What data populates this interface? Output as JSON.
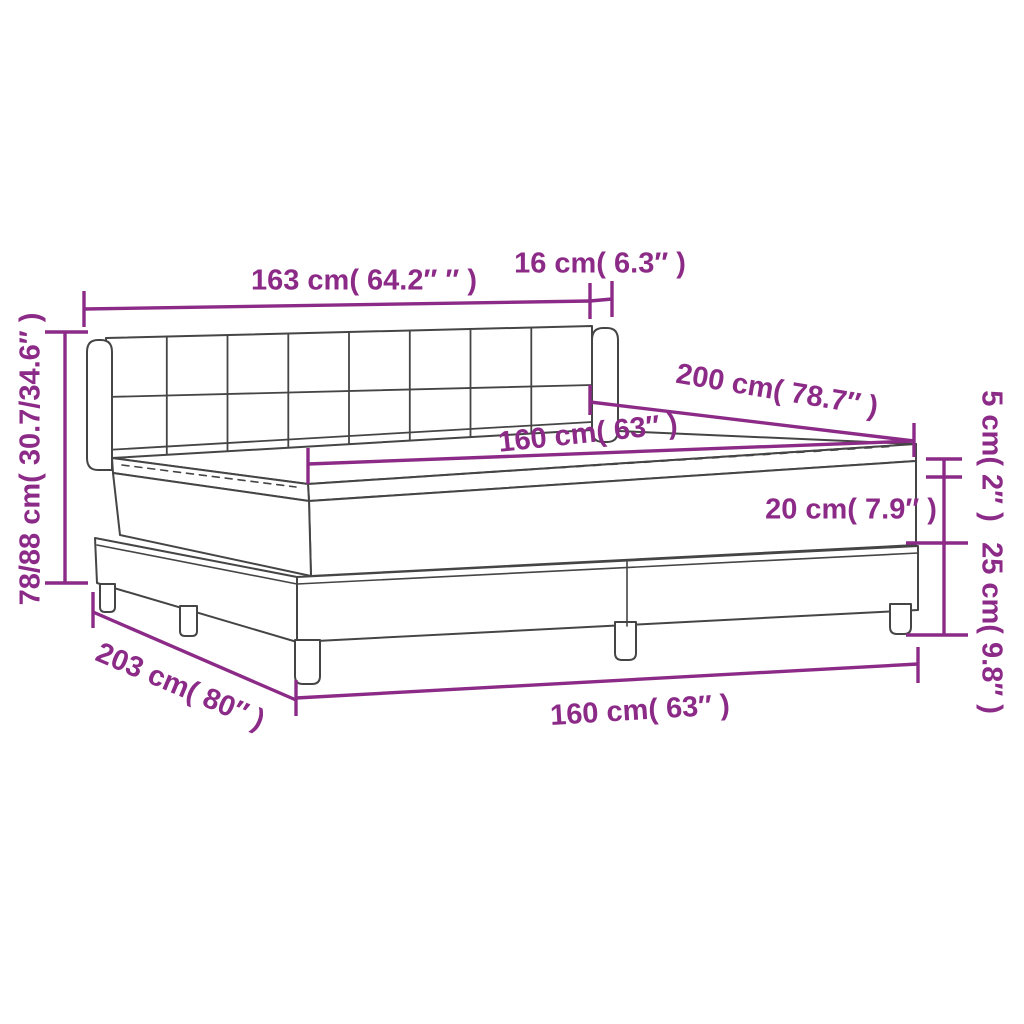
{
  "diagram": {
    "type": "product-dimension-diagram",
    "subject": "box-spring-bed-with-mattress-and-topper",
    "colors": {
      "dimension_accent": "#8c2b87",
      "line_art": "#454545",
      "background": "#ffffff"
    },
    "dimensions": {
      "headboard_width": "163 cm( 64.2″ ″ )",
      "headboard_side_depth": "16 cm( 6.3″ )",
      "bed_length_top": "200 cm( 78.7″ )",
      "mattress_width": "160 cm( 63″ )",
      "topper_height": "5 cm( 2″ )",
      "mattress_height": "20 cm( 7.9″ )",
      "base_height": "25 cm( 9.8″ )",
      "total_height": "78/88 cm( 30.7/34.6″ )",
      "total_length": "203 cm( 80″ )",
      "base_width": "160 cm( 63″ )"
    }
  }
}
